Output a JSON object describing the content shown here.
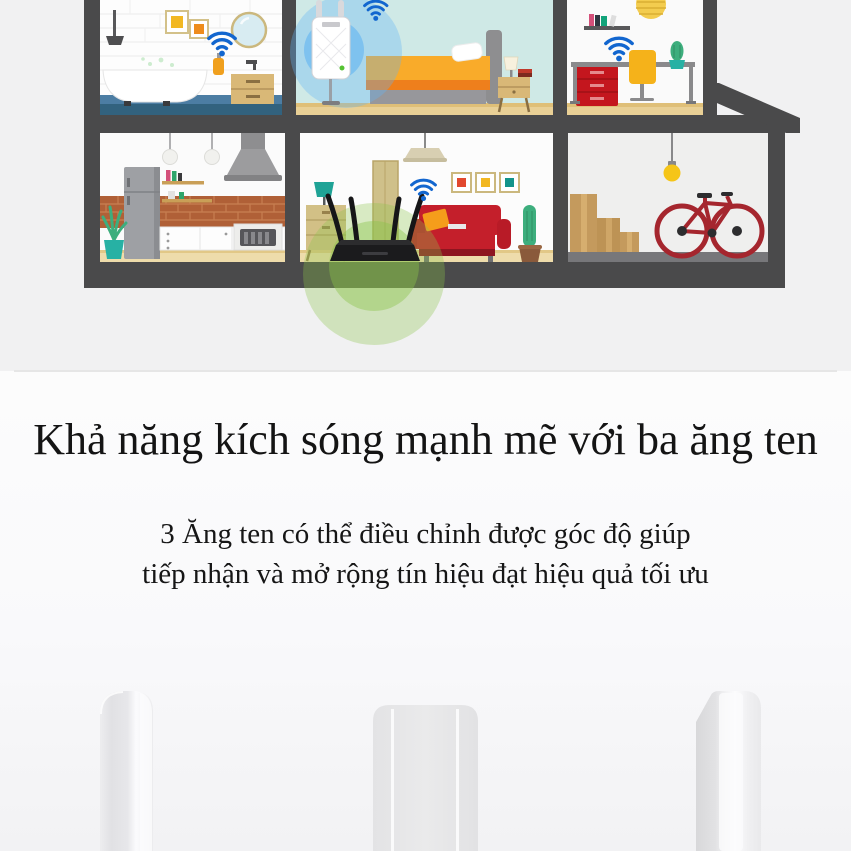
{
  "text": {
    "heading": "Khả năng kích sóng mạnh mẽ với ba ăng ten",
    "body_line1": "3 Ăng ten có thể điều chỉnh được góc độ giúp",
    "body_line2": "tiếp nhận và mở rộng tín hiệu đạt hiệu quả tối ưu"
  },
  "colors": {
    "section_top_bg": "#f1f1f2",
    "structure": "#4a4a4b",
    "wifi_blue": "#1266cf",
    "signal_glow_blue": "#64b5f6",
    "signal_glow_blue_inner": "#42a5f5",
    "signal_glow_green": "#8bc34a",
    "router_black": "#1b1b1d",
    "extender_white": "#ffffff",
    "extender_led_green": "#54c232",
    "sofa_red": "#c41f2b",
    "bed_orange": "#f9ab2a",
    "bike_red": "#a5262e",
    "drawer_red": "#c4161e",
    "accent_yellow": "#f2b822",
    "accent_orange": "#ee8c1c",
    "accent_teal": "#13948b",
    "wood_tan": "#d9b877",
    "floor_tan": "#e9d096",
    "bedroom_teal": "#cfe9e6",
    "bathroom_floor_blue": "#32627e",
    "brick": "#b06037",
    "divider": "#e6e6e6",
    "heading_text": "#141414",
    "antenna_gray": "#e6e6e8"
  },
  "icons": {
    "wifi": "wifi-signal-icon",
    "bulb": "hanging-bulb-icon"
  }
}
